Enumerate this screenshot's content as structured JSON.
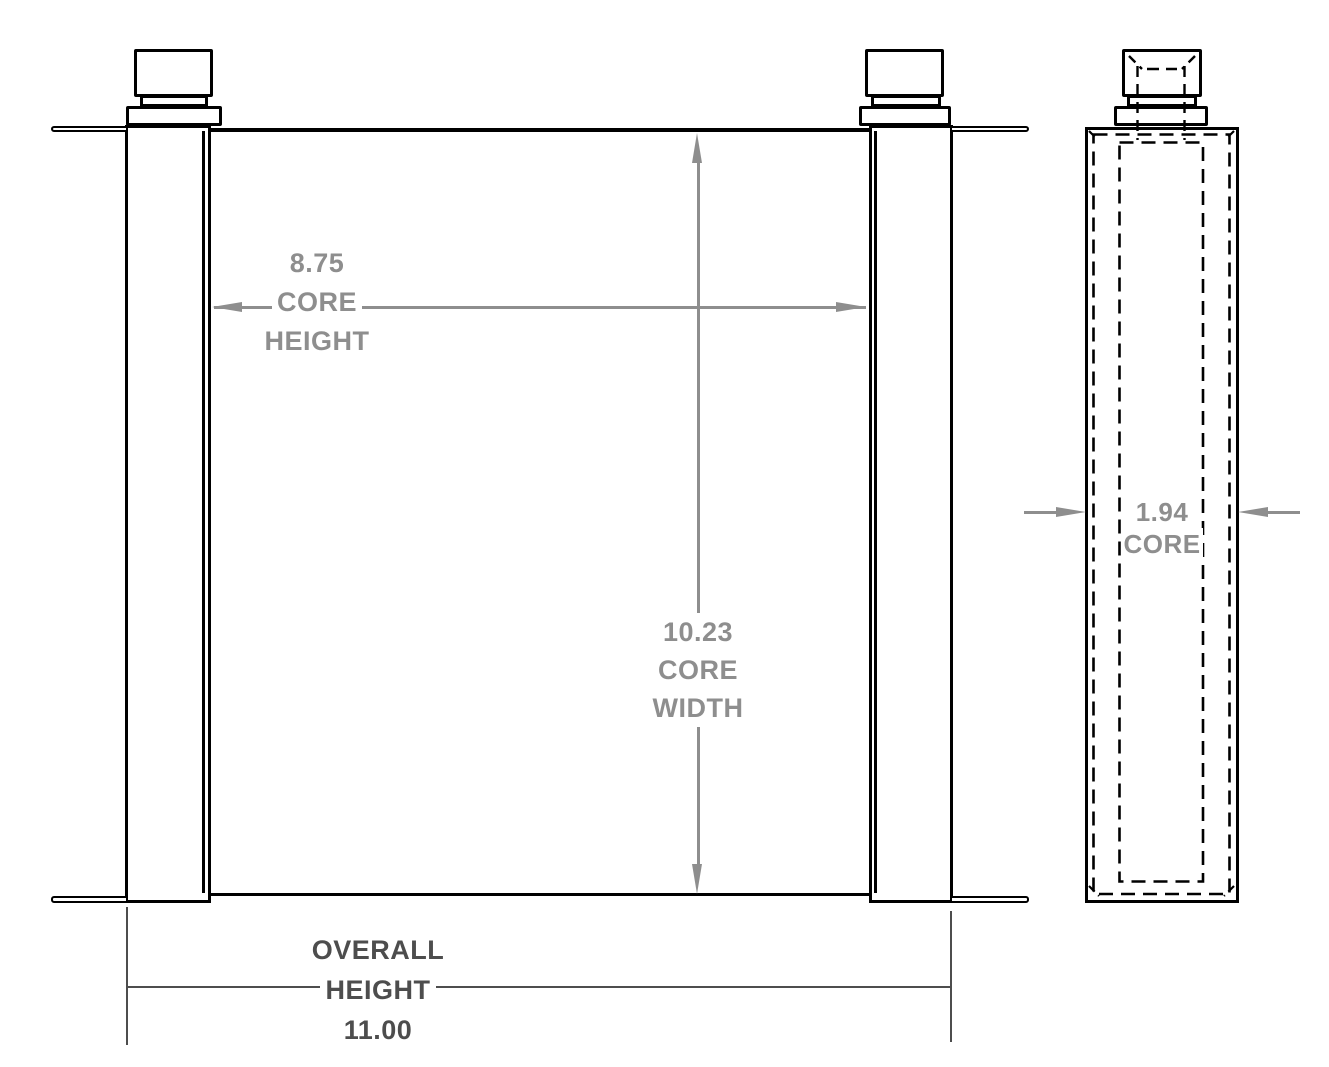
{
  "drawing": {
    "background_color": "#ffffff",
    "object_line_color": "#000000",
    "dimension_color": "#8e8e8e",
    "overall_dimension_color": "#4d4d4d",
    "front_view": {
      "core_height_dimension": {
        "value": "8.75",
        "label_line_1": "CORE",
        "label_line_2": "HEIGHT"
      },
      "core_width_dimension": {
        "value": "10.23",
        "label_line_1": "CORE",
        "label_line_2": "WIDTH"
      },
      "overall_height_dimension": {
        "label_line_1": "OVERALL",
        "label_line_2": "HEIGHT",
        "value": "11.00"
      }
    },
    "side_view": {
      "core_depth_dimension": {
        "value": "1.94",
        "label_line_1": "CORE"
      }
    }
  }
}
